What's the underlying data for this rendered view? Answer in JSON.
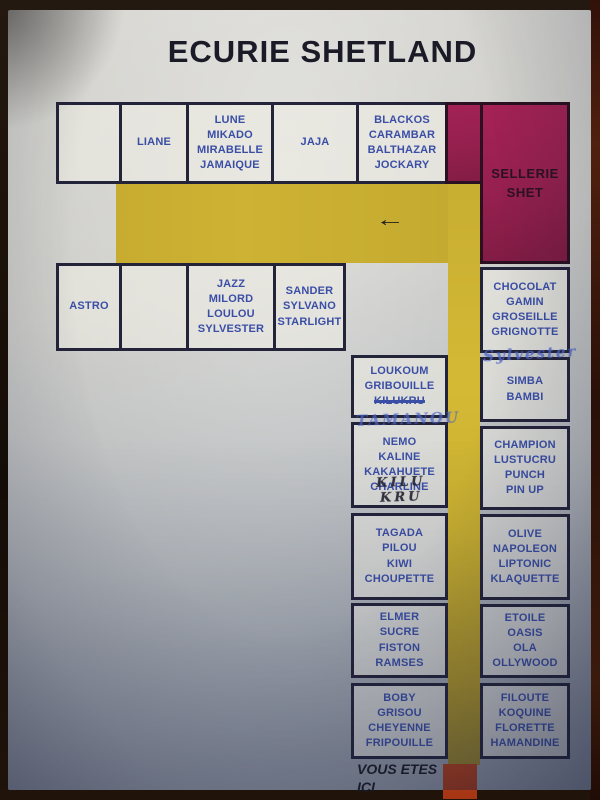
{
  "title": "ECURIE SHETLAND",
  "tack_room": {
    "names": [
      "SELLERIE",
      "SHET"
    ]
  },
  "corridor": {
    "arrow_icon": "←"
  },
  "you_are_here": {
    "label": [
      "VOUS ETES",
      "ICI"
    ]
  },
  "colors": {
    "corridor_yellow": "#ccb232",
    "tack_room_magenta": "#9e2053",
    "marker_red": "#ad3a17",
    "horse_name_blue": "#3a4ea6",
    "ink_dark": "#1b1b28"
  },
  "stalls": {
    "row1_empty": [],
    "row1_liane": [
      "LIANE"
    ],
    "row1_lune": [
      "LUNE",
      "MIKADO",
      "MIRABELLE",
      "JAMAIQUE"
    ],
    "row1_jaja": [
      "JAJA"
    ],
    "row1_blackos": [
      "BLACKOS",
      "CARAMBAR",
      "BALTHAZAR",
      "JOCKARY"
    ],
    "row2_astro": [
      "ASTRO"
    ],
    "row2_empty": [],
    "row2_jazz": [
      "JAZZ",
      "MILORD",
      "LOULOU",
      "SYLVESTER"
    ],
    "row2_sander": [
      "SANDER",
      "SYLVANO",
      "STARLIGHT"
    ],
    "mid_loukoum": {
      "names": [
        "LOUKOUM",
        "GRIBOUILLE"
      ],
      "crossed_out": "KILUKRU",
      "handwriting": "TAMANOU"
    },
    "mid_nemo": {
      "names": [
        "NEMO",
        "KALINE",
        "KAKAHUETE",
        "CHARLINE"
      ],
      "handwriting": "KILU KRU"
    },
    "mid_tagada": [
      "TAGADA",
      "PILOU",
      "KIWI",
      "CHOUPETTE"
    ],
    "mid_elmer": [
      "ELMER",
      "SUCRE",
      "FISTON",
      "RAMSES"
    ],
    "mid_boby": [
      "BOBY",
      "GRISOU",
      "CHEYENNE",
      "FRIPOUILLE"
    ],
    "right_chocolat": {
      "names": [
        "CHOCOLAT",
        "GAMIN",
        "GROSEILLE",
        "GRIGNOTTE"
      ],
      "handwriting": "Sylvester"
    },
    "right_simba": [
      "SIMBA",
      "BAMBI"
    ],
    "right_champion": [
      "CHAMPION",
      "LUSTUCRU",
      "PUNCH",
      "PIN UP"
    ],
    "right_olive": [
      "OLIVE",
      "NAPOLEON",
      "LIPTONIC",
      "KLAQUETTE"
    ],
    "right_etoile": [
      "ETOILE",
      "OASIS",
      "OLA",
      "OLLYWOOD"
    ],
    "right_filoute": [
      "FILOUTE",
      "KOQUINE",
      "FLORETTE",
      "HAMANDINE"
    ]
  }
}
